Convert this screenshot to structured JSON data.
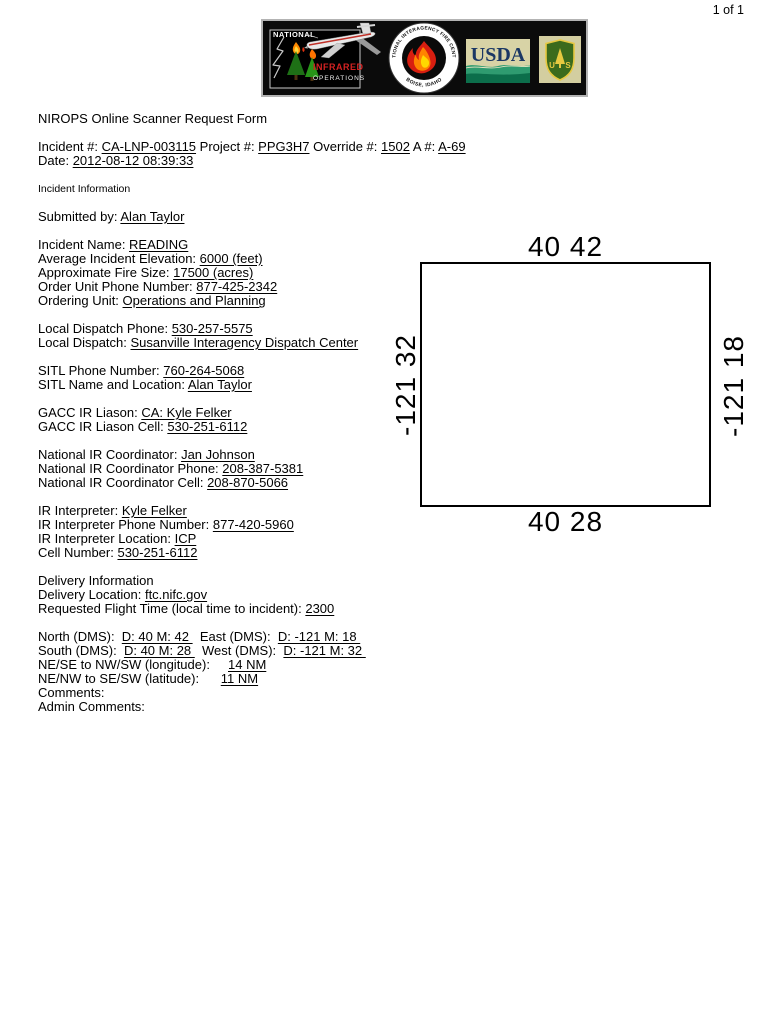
{
  "page": {
    "indicator": "1 of 1"
  },
  "header": {
    "nirops": {
      "national": "NATIONAL",
      "infrared": "INFRARED",
      "operations": "OPERATIONS"
    },
    "nifc": {
      "arc_top": "NATIONAL INTERAGENCY FIRE CENTER",
      "arc_bottom": "BOISE, IDAHO"
    },
    "usda": {
      "name": "USDA"
    },
    "forest_service": {
      "letter_left": "U",
      "letter_right": "S"
    }
  },
  "form": {
    "lines": [
      {
        "segments": [
          {
            "t": "NIROPS Online Scanner Request Form"
          }
        ]
      },
      {
        "segments": []
      },
      {
        "segments": [
          {
            "t": "Incident #: "
          },
          {
            "t": "CA-LNP-003115",
            "u": true
          },
          {
            "t": " Project #: "
          },
          {
            "t": "PPG3H7",
            "u": true
          },
          {
            "t": " Override #: "
          },
          {
            "t": "1502",
            "u": true
          },
          {
            "t": " A #: "
          },
          {
            "t": "A-69",
            "u": true
          }
        ]
      },
      {
        "segments": [
          {
            "t": "Date: "
          },
          {
            "t": "2012-08-12 08:39:33",
            "u": true
          }
        ]
      },
      {
        "segments": []
      },
      {
        "small": true,
        "segments": [
          {
            "t": "Incident Information"
          }
        ]
      },
      {
        "segments": []
      },
      {
        "segments": [
          {
            "t": "Submitted by: "
          },
          {
            "t": "Alan Taylor",
            "u": true
          }
        ]
      },
      {
        "segments": []
      },
      {
        "segments": [
          {
            "t": "Incident Name: "
          },
          {
            "t": "READING",
            "u": true
          }
        ]
      },
      {
        "segments": [
          {
            "t": "Average Incident Elevation: "
          },
          {
            "t": "6000 (feet)",
            "u": true
          }
        ]
      },
      {
        "segments": [
          {
            "t": "Approximate Fire Size: "
          },
          {
            "t": "17500 (acres)",
            "u": true
          }
        ]
      },
      {
        "segments": [
          {
            "t": "Order Unit Phone Number: "
          },
          {
            "t": "877-425-2342",
            "u": true
          }
        ]
      },
      {
        "segments": [
          {
            "t": "Ordering Unit: "
          },
          {
            "t": "Operations and Planning",
            "u": true
          }
        ]
      },
      {
        "segments": []
      },
      {
        "segments": [
          {
            "t": "Local Dispatch Phone: "
          },
          {
            "t": "530-257-5575",
            "u": true
          }
        ]
      },
      {
        "segments": [
          {
            "t": "Local Dispatch: "
          },
          {
            "t": "Susanville Interagency Dispatch Center",
            "u": true
          }
        ]
      },
      {
        "segments": []
      },
      {
        "segments": [
          {
            "t": "SITL Phone Number: "
          },
          {
            "t": "760-264-5068",
            "u": true
          }
        ]
      },
      {
        "segments": [
          {
            "t": "SITL Name and Location: "
          },
          {
            "t": "Alan Taylor",
            "u": true
          }
        ]
      },
      {
        "segments": []
      },
      {
        "segments": [
          {
            "t": "GACC IR Liason: "
          },
          {
            "t": "CA: Kyle Felker",
            "u": true
          }
        ]
      },
      {
        "segments": [
          {
            "t": "GACC IR Liason Cell: "
          },
          {
            "t": "530-251-6112",
            "u": true
          }
        ]
      },
      {
        "segments": []
      },
      {
        "segments": [
          {
            "t": "National IR Coordinator: "
          },
          {
            "t": "Jan Johnson",
            "u": true
          }
        ]
      },
      {
        "segments": [
          {
            "t": "National IR Coordinator Phone: "
          },
          {
            "t": "208-387-5381",
            "u": true
          }
        ]
      },
      {
        "segments": [
          {
            "t": "National IR Coordinator Cell: "
          },
          {
            "t": "208-870-5066",
            "u": true
          }
        ]
      },
      {
        "segments": []
      },
      {
        "segments": [
          {
            "t": "IR Interpreter: "
          },
          {
            "t": "Kyle Felker",
            "u": true
          }
        ]
      },
      {
        "segments": [
          {
            "t": "IR Interpreter Phone Number: "
          },
          {
            "t": "877-420-5960",
            "u": true
          }
        ]
      },
      {
        "segments": [
          {
            "t": "IR Interpreter Location: "
          },
          {
            "t": "ICP",
            "u": true
          }
        ]
      },
      {
        "segments": [
          {
            "t": "Cell Number: "
          },
          {
            "t": "530-251-6112",
            "u": true
          }
        ]
      },
      {
        "segments": []
      },
      {
        "segments": [
          {
            "t": "Delivery Information"
          }
        ]
      },
      {
        "segments": [
          {
            "t": "Delivery Location: "
          },
          {
            "t": "ftc.nifc.gov",
            "u": true
          }
        ]
      },
      {
        "segments": [
          {
            "t": "Requested Flight Time (local time to incident): "
          },
          {
            "t": "2300",
            "u": true
          }
        ]
      },
      {
        "segments": []
      },
      {
        "segments": [
          {
            "t": "North (DMS):  "
          },
          {
            "t": "D: 40 M: 42 ",
            "u": true
          },
          {
            "t": "  East (DMS):  "
          },
          {
            "t": "D: -121 M: 18 ",
            "u": true
          }
        ]
      },
      {
        "segments": [
          {
            "t": "South (DMS):  "
          },
          {
            "t": "D: 40 M: 28 ",
            "u": true
          },
          {
            "t": "  West (DMS):  "
          },
          {
            "t": "D: -121 M: 32 ",
            "u": true
          }
        ]
      },
      {
        "segments": [
          {
            "t": "NE/SE to NW/SW (longitude):     "
          },
          {
            "t": "14 NM",
            "u": true
          }
        ]
      },
      {
        "segments": [
          {
            "t": "NE/NW to SE/SW (latitude):      "
          },
          {
            "t": "11 NM",
            "u": true
          }
        ]
      },
      {
        "segments": [
          {
            "t": "Comments:"
          }
        ]
      },
      {
        "segments": [
          {
            "t": "Admin Comments:"
          }
        ]
      }
    ]
  },
  "map": {
    "north_label": "40 42",
    "south_label": "40 28",
    "west_label": "-121 32",
    "east_label": "-121 18"
  },
  "colors": {
    "banner_background": "#0b0b0b",
    "infrared_red": "#d42222",
    "usda_navy": "#1b3764",
    "usda_green": "#2f9b70",
    "shield_green": "#3c6b1c",
    "shield_gold": "#e7c940"
  }
}
